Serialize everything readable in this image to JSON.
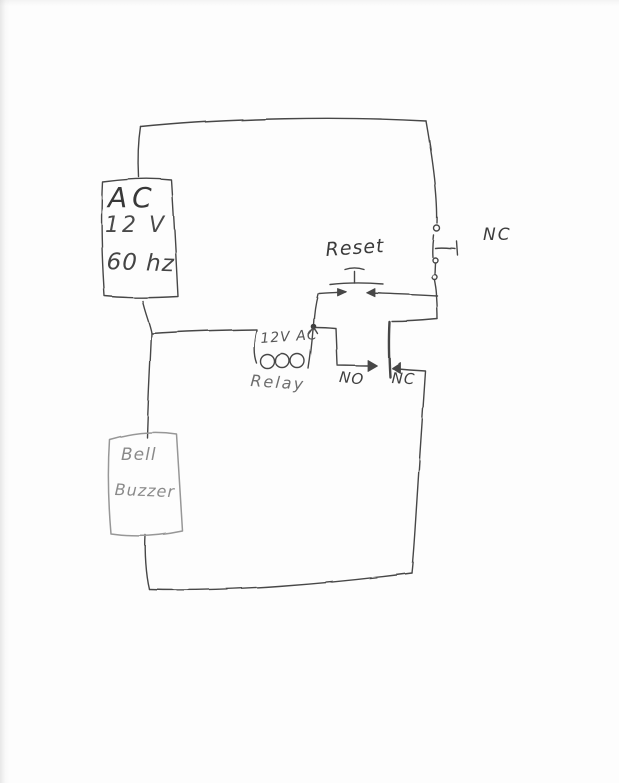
{
  "title": "Hand-drawn relay bell circuit sketch",
  "labels": {
    "source": {
      "line1": "AC",
      "line2": "12 V",
      "line3": "60 hz"
    },
    "reset_button": "Reset",
    "stop_button_nc": "NC",
    "relay_coil_rating": "12V AC",
    "relay_coil": "Relay",
    "contact_no": "NO",
    "contact_nc": "NC",
    "load": {
      "line1": "Bell",
      "line2": "Buzzer"
    }
  },
  "colors": {
    "ink": "#474747",
    "pencil": "#979797",
    "paper": "#fdfdfd"
  }
}
